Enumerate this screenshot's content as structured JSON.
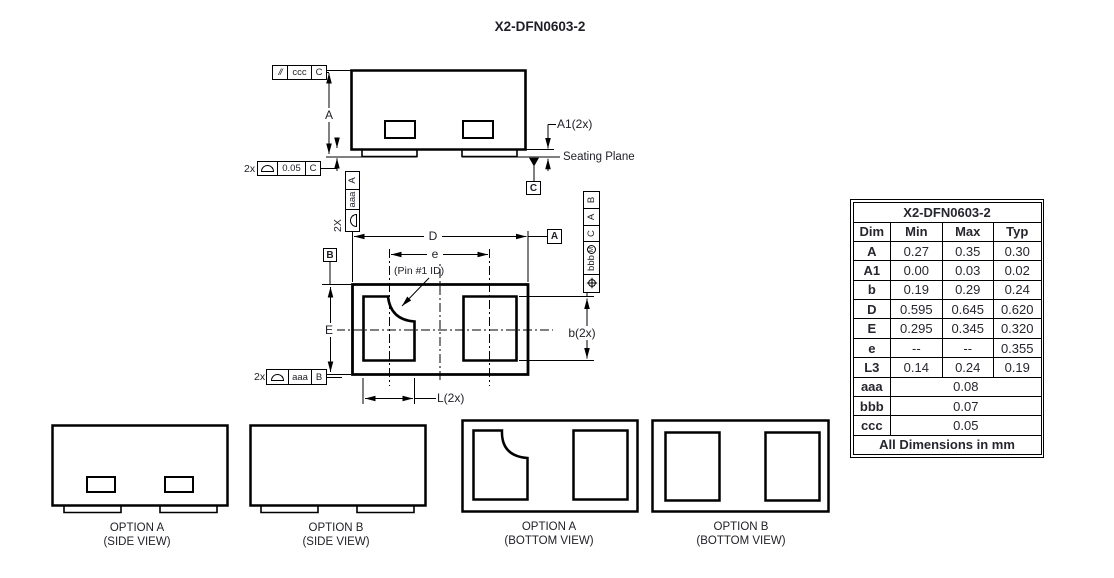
{
  "title": "X2-DFN0603-2",
  "side_view": {
    "dim_a": "A",
    "dim_a1": "A1(2x)",
    "seating_plane": "Seating Plane",
    "datum_c": "C",
    "fcf_parallelism": {
      "symbol": "//",
      "tolerance": "ccc",
      "datum": "C"
    },
    "fcf_seating": {
      "prefix": "2x",
      "tolerance": "0.05",
      "datum": "C"
    },
    "fcf_feet": {
      "prefix": "2X",
      "tolerance": "aaa",
      "datum": "A"
    }
  },
  "bottom_view": {
    "dim_d": "D",
    "pitch": "e",
    "dim_e": "E",
    "dim_b": "b(2x)",
    "dim_l": "L(2x)",
    "pin1_label": "(Pin #1 ID)",
    "datum_a": "A",
    "datum_b": "B",
    "fcf_pads": {
      "prefix": "2x",
      "tolerance": "aaa",
      "datum": "B"
    },
    "fcf_position": {
      "tolerance": "bbb",
      "modifier": "M",
      "datum1": "C",
      "datum2": "A",
      "datum3": "B"
    }
  },
  "options": [
    {
      "name": "OPTION A",
      "view": "(SIDE VIEW)"
    },
    {
      "name": "OPTION B",
      "view": "(SIDE VIEW)"
    },
    {
      "name": "OPTION A",
      "view": "(BOTTOM VIEW)"
    },
    {
      "name": "OPTION  B",
      "view": "(BOTTOM VIEW)"
    }
  ],
  "table": {
    "title": "X2-DFN0603-2",
    "headers": [
      "Dim",
      "Min",
      "Max",
      "Typ"
    ],
    "rows": [
      {
        "dim": "A",
        "min": "0.27",
        "max": "0.35",
        "typ": "0.30"
      },
      {
        "dim": "A1",
        "min": "0.00",
        "max": "0.03",
        "typ": "0.02"
      },
      {
        "dim": "b",
        "min": "0.19",
        "max": "0.29",
        "typ": "0.24"
      },
      {
        "dim": "D",
        "min": "0.595",
        "max": "0.645",
        "typ": "0.620"
      },
      {
        "dim": "E",
        "min": "0.295",
        "max": "0.345",
        "typ": "0.320"
      },
      {
        "dim": "e",
        "min": "--",
        "max": "--",
        "typ": "0.355"
      },
      {
        "dim": "L3",
        "min": "0.14",
        "max": "0.24",
        "typ": "0.19"
      }
    ],
    "span_rows": [
      {
        "dim": "aaa",
        "value": "0.08"
      },
      {
        "dim": "bbb",
        "value": "0.07"
      },
      {
        "dim": "ccc",
        "value": "0.05"
      }
    ],
    "footer": "All Dimensions in mm"
  }
}
